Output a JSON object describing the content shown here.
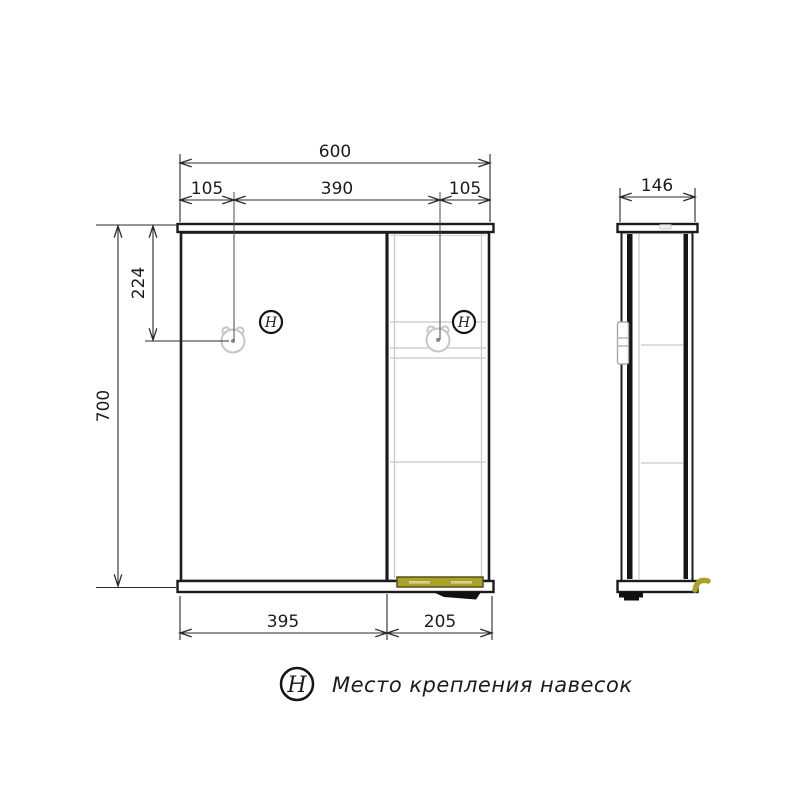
{
  "drawing": {
    "front": {
      "width_total": "600",
      "hanger_left_offset": "105",
      "hanger_span": "390",
      "hanger_right_offset": "105",
      "height_total": "700",
      "hanger_top_offset": "224",
      "door_width": "395",
      "shelf_width": "205"
    },
    "side": {
      "depth": "146"
    },
    "marker_symbol": "H",
    "legend_text": "Место крепления навесок",
    "colors": {
      "line": "#1c1c1c",
      "dim": "#2b2b2b",
      "construction": "#c6c6c6",
      "light_fixture": "#a9a32c",
      "light_fixture_edge": "#55511a",
      "light_fixture_slot": "#d6d18f"
    }
  }
}
